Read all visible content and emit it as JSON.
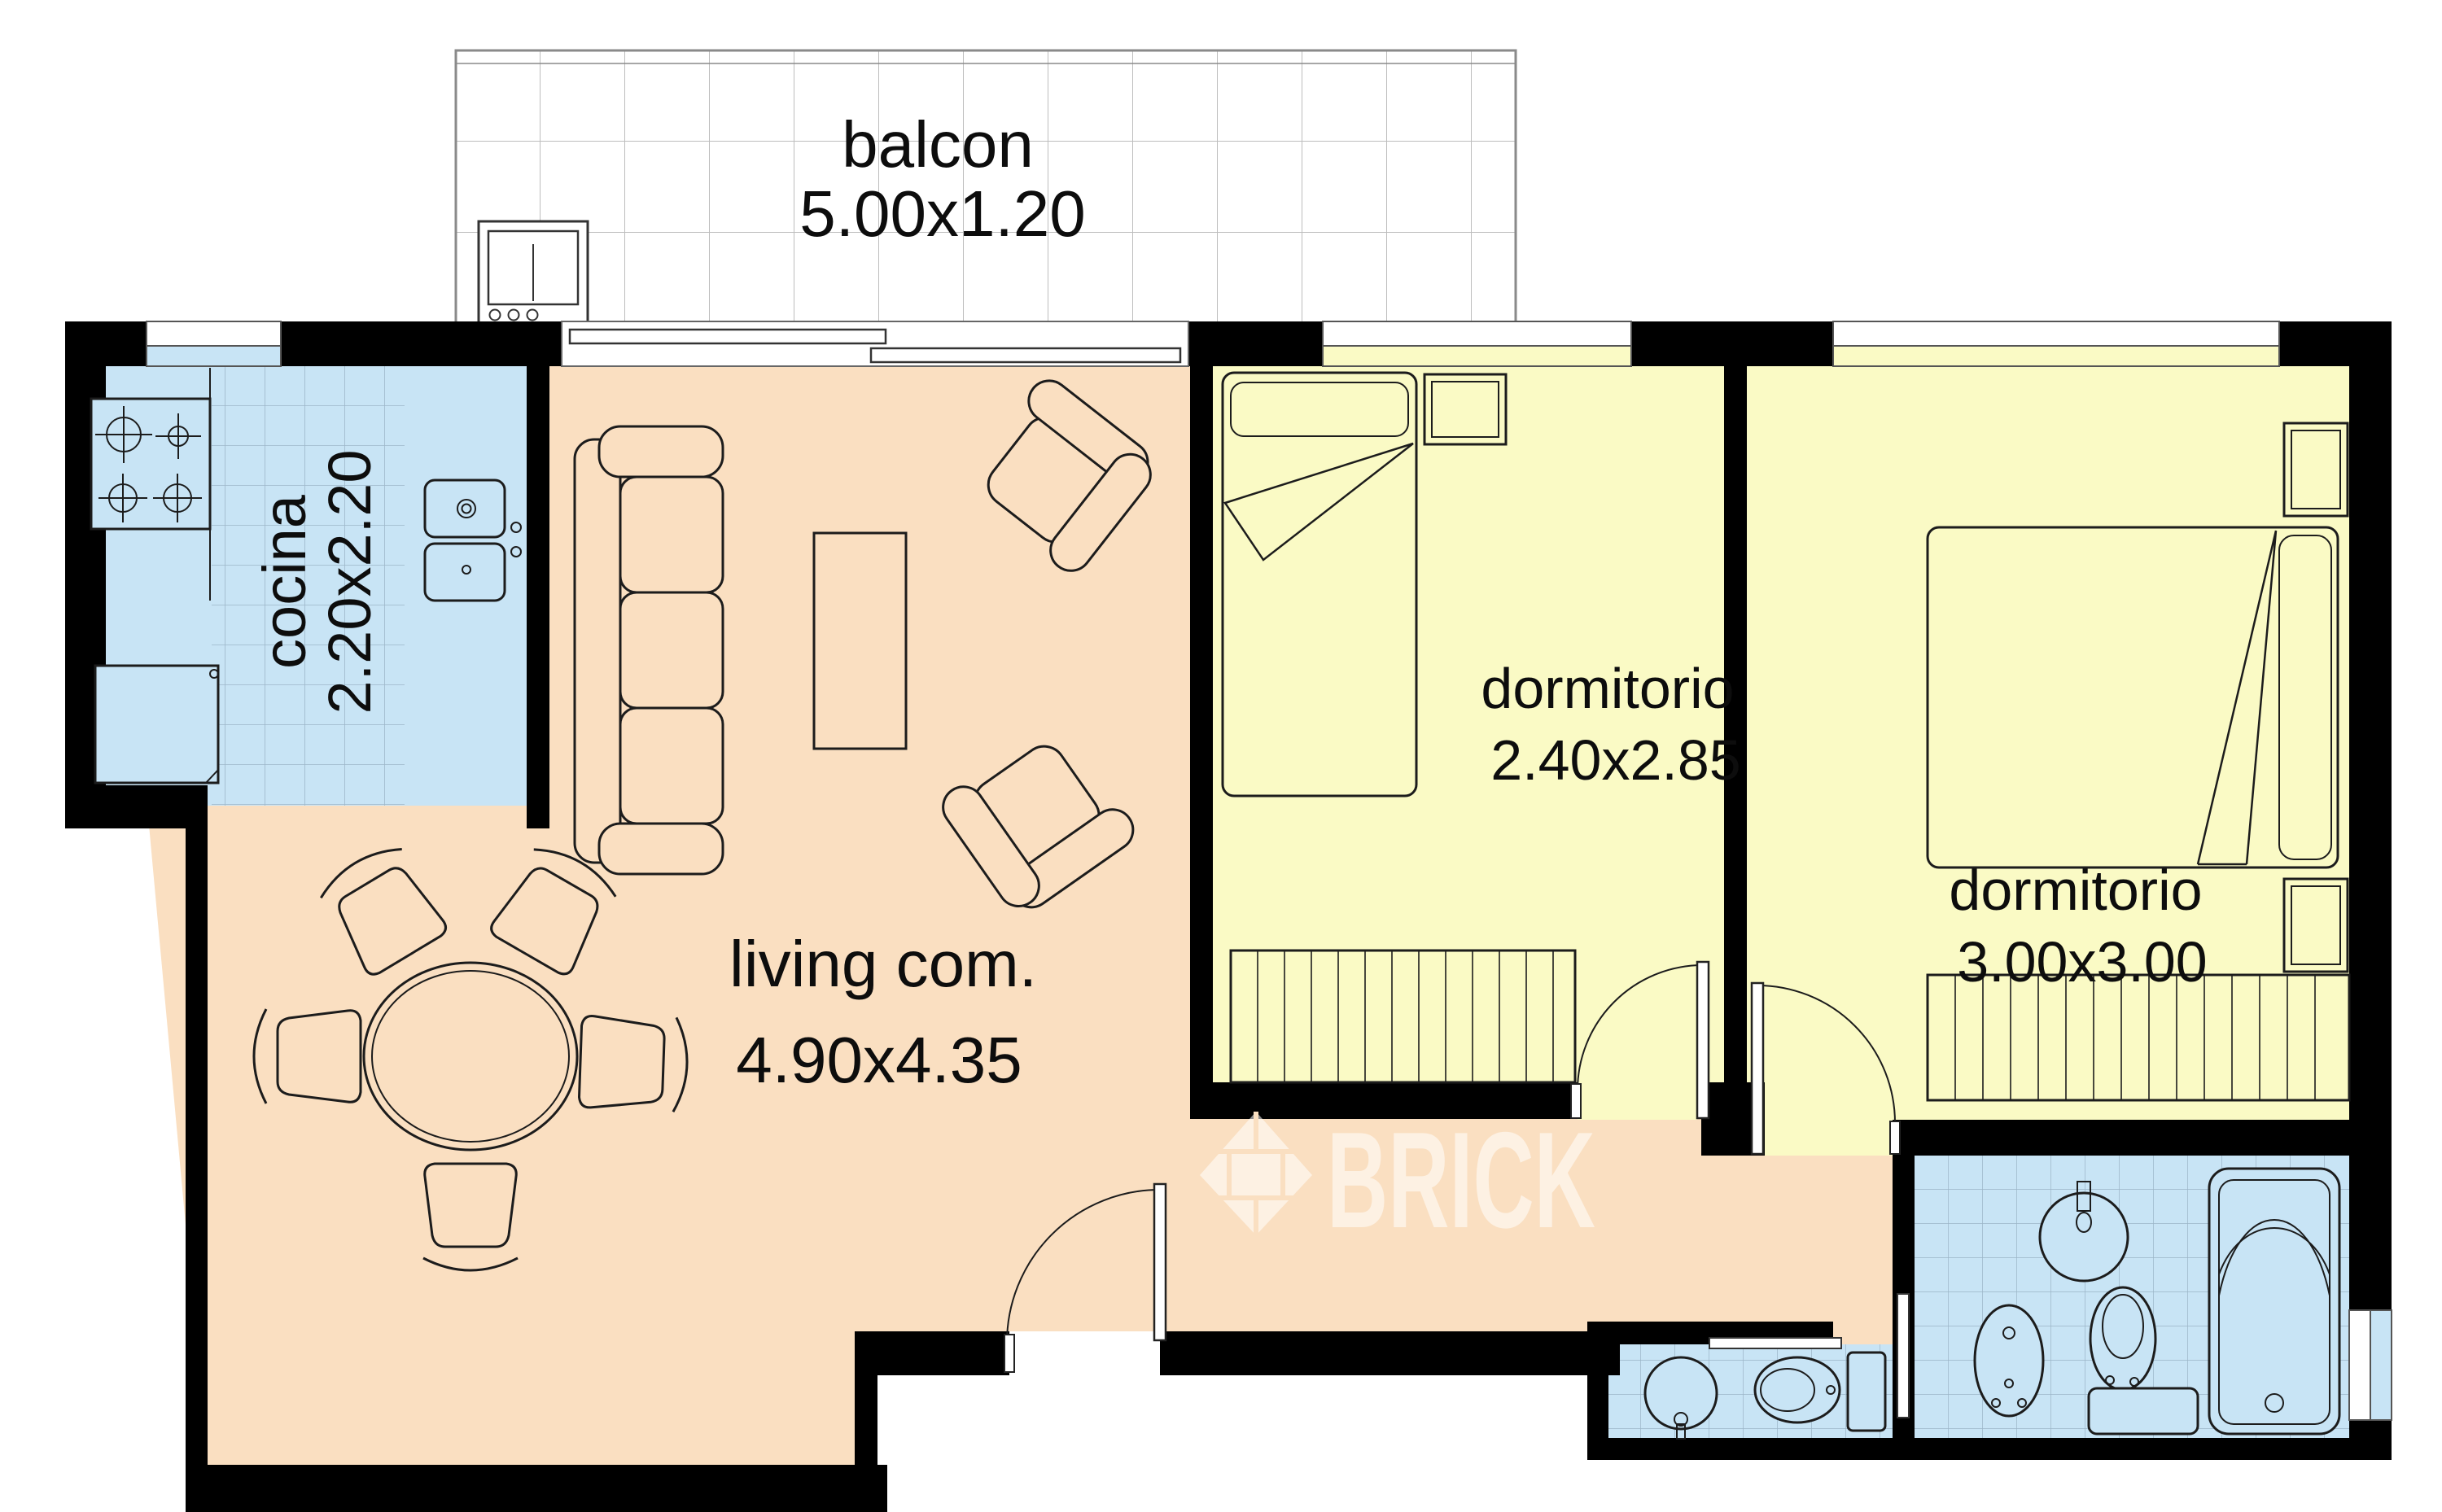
{
  "rooms": {
    "balcony": {
      "label": "balcon",
      "dims": "5.00x1.20"
    },
    "kitchen": {
      "label": "cocina",
      "dims": "2.20x2.20"
    },
    "living": {
      "label": "living com.",
      "dims": "4.90x4.35"
    },
    "bedroom1": {
      "label": "dormitorio",
      "dims": "2.40x2.85"
    },
    "bedroom2": {
      "label": "dormitorio",
      "dims": "3.00x3.00"
    }
  },
  "watermark": {
    "brand": "BRICK"
  },
  "colors": {
    "wall": "#000000",
    "floor-living": "#fadfc1",
    "floor-bedroom": "#fafac5",
    "floor-kitchen": "#c8e4f5",
    "floor-bath": "#c8e4f5",
    "tile-line": "#8fa8bb",
    "balcony-line": "#bdbdbd",
    "outline": "#1c1c1c"
  }
}
